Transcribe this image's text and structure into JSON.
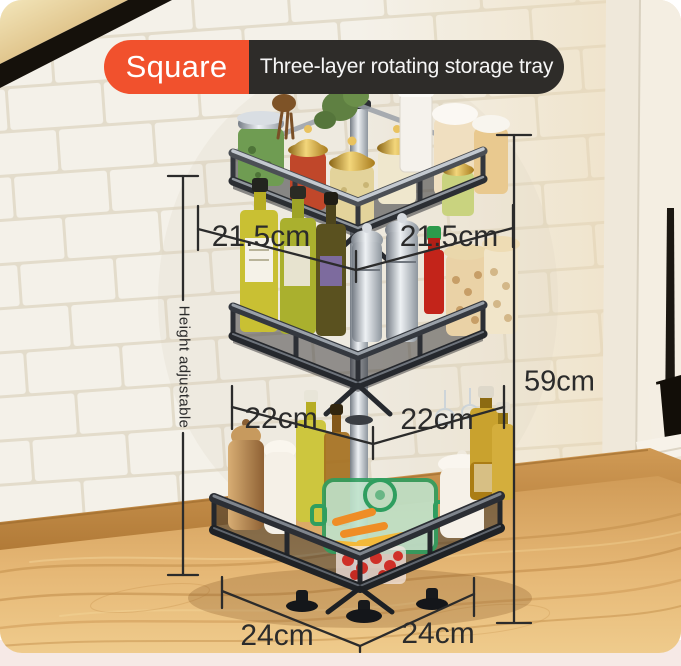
{
  "banner": {
    "tag": "Square",
    "title": "Three-layer rotating storage tray",
    "tag_bg": "#F1512D",
    "title_bg": "#2E2C29",
    "text_color": "#FFFFFF"
  },
  "measurements": {
    "tier1_left": "21.5cm",
    "tier1_right": "21.5cm",
    "tier2_left": "22cm",
    "tier2_right": "22cm",
    "tier3_left": "24cm",
    "tier3_right": "24cm",
    "total_height": "59cm",
    "height_note": "Height adjustable",
    "line_color": "#2B2B2B"
  },
  "scene": {
    "wall_tile_color": "#F4F1E9",
    "grout_color": "#E3DCCB",
    "counter_wood_color": "#E2B173",
    "baseboard_color": "#C68A48",
    "window_frame_color": "#F5EFE5",
    "window_glass_color": "#17130E",
    "rack_metal_color": "#2A2D33",
    "pole_chrome_color": "#C9CED4",
    "bottom_strip_color": "#F6E9E6"
  }
}
